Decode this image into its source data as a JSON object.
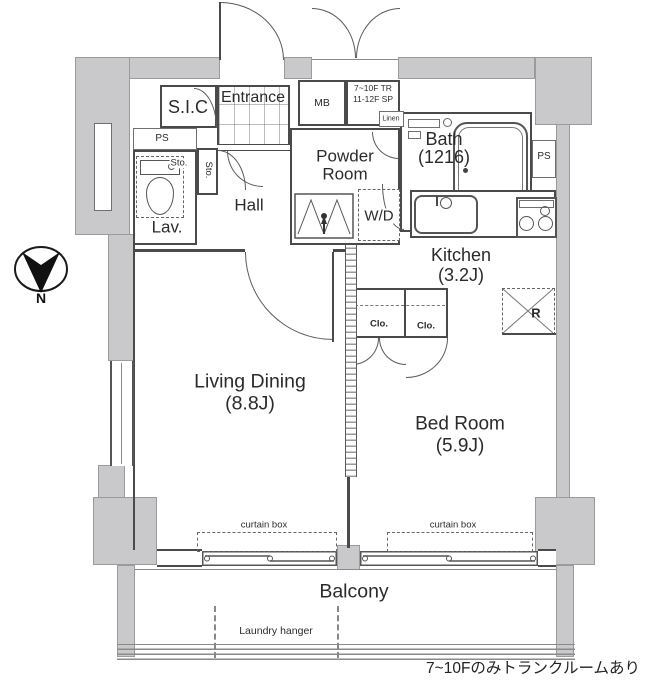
{
  "note": "7~10Fのみトランクルームあり",
  "compass": {
    "n": "N"
  },
  "labels": {
    "sic": "S.I.C",
    "entrance": "Entrance",
    "mb": "MB",
    "tr_line1": "7~10F TR",
    "tr_line2": "11-12F SP",
    "linen": "Linen",
    "bath_name": "Bath",
    "bath_size": "(1216)",
    "ps_right": "PS",
    "ps_left": "PS",
    "sto_top": "Sto.",
    "sto_side": "Sto.",
    "lav": "Lav.",
    "hall": "Hall",
    "powder_line1": "Powder",
    "powder_line2": "Room",
    "wd": "W/D",
    "kitchen_name": "Kitchen",
    "kitchen_size": "(3.2J)",
    "fridge": "R",
    "clo_left": "Clo.",
    "clo_right": "Clo.",
    "living_name": "Living Dining",
    "living_size": "(8.8J)",
    "bedroom_name": "Bed Room",
    "bedroom_size": "(5.9J)",
    "curtain_left": "curtain box",
    "curtain_right": "curtain box",
    "balcony": "Balcony",
    "laundry": "Laundry hanger"
  }
}
